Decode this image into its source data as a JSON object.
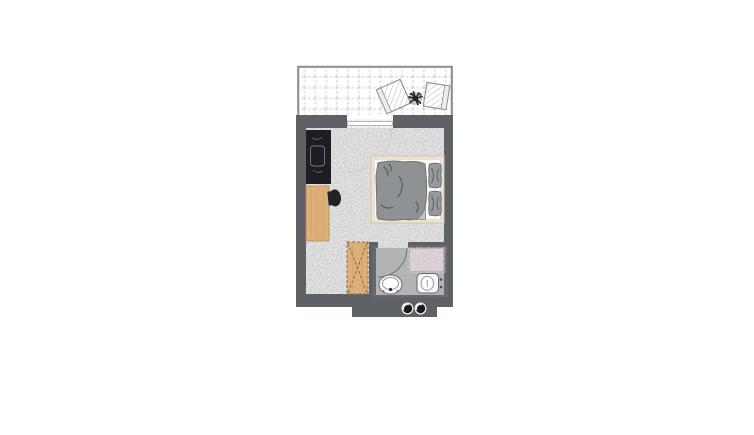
{
  "palette": {
    "wall": "#5e6165",
    "balcony_border": "#8f9394",
    "tile_line": "#c3c3c3",
    "carpet": "#d8d8d8",
    "bath_floor": "#b0b2b4",
    "mosaic": "#d7ced3",
    "wood": "#dcb078",
    "wood_line": "#a87f48",
    "desk": "#1c1e22",
    "bed_frame": "#ebe4d2",
    "mattress": "#fcfbf7",
    "duvet": "#8f9295",
    "pillow": "#97999c",
    "textile_line": "#5a5d60",
    "fixture_fill": "#f6f6f5",
    "fixture_stroke": "#6a6d70",
    "tv": "#212327",
    "plant": "#2b2e27",
    "downlight_dark": "#17181b",
    "downlight_light": "#f2f2f2"
  },
  "floorplan": {
    "areas": [
      {
        "id": "balcony",
        "items": [
          "chair",
          "plant",
          "chair"
        ]
      },
      {
        "id": "main-room",
        "items": [
          "dark-cabinet",
          "wooden-sideboard",
          "tv",
          "double-bed",
          "duvet",
          "pillow",
          "pillow"
        ]
      },
      {
        "id": "bathroom",
        "items": [
          "door-swing",
          "shower-mosaic",
          "washbasin",
          "toilet"
        ]
      },
      {
        "id": "hall",
        "items": [
          "wardrobe-crossed"
        ]
      },
      {
        "id": "entrance",
        "items": [
          "downlight-symbol",
          "downlight-symbol"
        ]
      }
    ]
  }
}
